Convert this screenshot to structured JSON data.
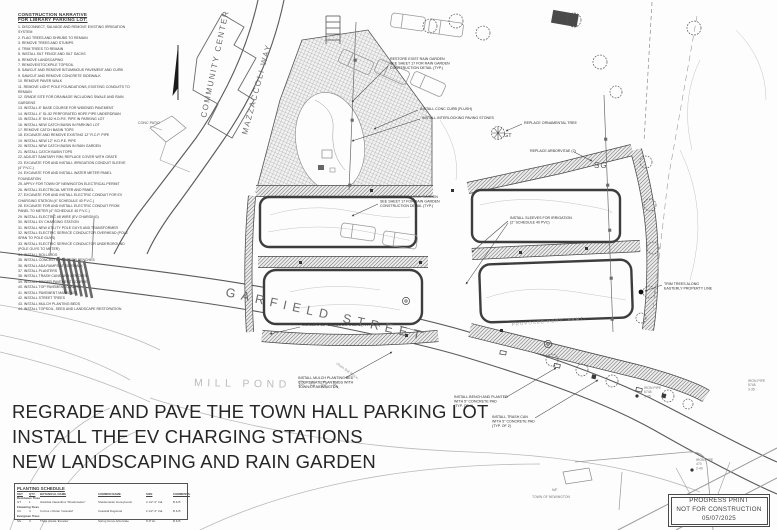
{
  "narrative": {
    "title": "CONSTRUCTION NARRATIVE",
    "subtitle": "FOR LIBRARY PARKING LOT:",
    "items": [
      "DISCONNECT, SALVAGE AND REMOVE EXISTING IRRIGATION SYSTEM",
      "FLAG TREES AND SHRUBS TO REMAIN",
      "REMOVE TREES AND STUMPS",
      "TRIM TREES TO REMAIN",
      "INSTALL SILT FENCE AND SILT SACKS",
      "REMOVE LANDSCAPING",
      "REMOVE/STOCKPILE TOPSOIL",
      "SAWCUT AND REMOVE BITUMINOUS PAVEMENT AND CURB",
      "SAWCUT AND REMOVE CONCRETE SIDEWALK",
      "REMOVE PAVER WALK",
      "REMOVE LIGHT POLE FOUNDATIONS; EXISTING CONDUITS TO REMAIN",
      "GRADE SITE FOR DRAINAGE INCLUDING SWALE AND RAIN GARDENS",
      "INSTALL 8\" BASE COURSE FOR WIDENED PAVEMENT",
      "INSTALL 4\" SL-52 PERFORATED HDPE PIPE UNDERDRAIN",
      "INSTALL 8\" SH-52 H.D.P.E. PIPE IN PARKING LOT",
      "INSTALL NEW CATCH BASIN IN PARKING LOT",
      "REMOVE CATCH BASIN TOPS",
      "EXCAVATE AND REMOVE EXISTING 12\" R.C.P. PIPE",
      "INSTALL NEW 12\" H.D.P.E. PIPE",
      "INSTALL NEW CATCH BASIN IN RAIN GARDEN",
      "INSTALL CATCH BASIN TOPS",
      "ADJUST SANITARY RIM; REPLACE COVER WITH GRATE",
      "EXCAVATE FOR AND INSTALL IRRIGATION CONDUIT SLEEVE (4\" P.V.C.)",
      "EXCAVATE FOR AND INSTALL WATER METER PANEL FOUNDATION",
      "APPLY FOR TOWN OF NEWINGTON ELECTRICAL PERMIT",
      "INSTALL ELECTRICAL METER AND PANEL",
      "EXCAVATE FOR AND INSTALL ELECTRIC CONDUIT FOR EV CHARGING STATION (4\" SCHEDULE 40 P.V.C.)",
      "EXCAVATE FOR AND INSTALL ELECTRIC CONDUIT FROM PANEL TO METER (4\" SCHEDULE 40 P.V.C.)",
      "INSTALL ELECTRIC #8 WIRE (EV CHARGING)",
      "INSTALL EV CHARGING STATION",
      "INSTALL NEW UTILITY POLE GUYS AND TRANSFORMER",
      "INSTALL ELECTRIC SERVICE CONDUCTOR OVERHEAD (POLE SPAN TO POLE GUYS)",
      "INSTALL ELECTRIC SERVICE CONDUCTOR UNDERGROUND (POLE GUYS TO METER)",
      "INSTALL BOLLARDS",
      "INSTALL CONCRETE PADS FOR BENCHES",
      "INSTALL ADA RAMPS AT SIDEWALK",
      "INSTALL PLANTERS",
      "INSTALL TRASH CANS AND BENCHES",
      "INSTALL BINDER PAVEMENT COURSE",
      "INSTALL TOP PAVEMENT COURSE",
      "INSTALL PAVEMENT MARKINGS",
      "INSTALL STREET TREES",
      "INSTALL MULCH PLANTING BEDS",
      "INSTALL TOPSOIL, SEED AND LANDSCAPE RESTORATION"
    ]
  },
  "map": {
    "labels": {
      "garfield": "GARFIELD STREET",
      "mill_pond": "MILL POND PARK",
      "mazzaccoli": "MAZZACCOLI WAY",
      "community_center": "COMMUNITY CENTER",
      "conc_patio": "CONC PATIO",
      "nf": "N/F",
      "town": "TOWN OF NEWINGTON",
      "perv": "PROPOSED PERV. PVMT.",
      "fence": "chain link fence",
      "sg": "SG",
      "gt": "GT"
    },
    "survey1": {
      "l1": "IRON PIPE",
      "l2": "6748",
      "l3": "3-35"
    },
    "survey2": {
      "l1": "IRON PIPE",
      "l2": "470",
      "l3": "2-40"
    },
    "survey3": {
      "l1": "IRON PIPE",
      "l2": "5748",
      "l3": "3-35"
    },
    "callouts": [
      {
        "lines": [
          "RESTORE EXIST RAIN GARDEN",
          "SEE SHEET 17 FOR RAIN GARDEN",
          "CONSTRUCTION DETAIL (TYP.)"
        ]
      },
      {
        "lines": [
          "INSTALL CONC CURB (FLUSH)"
        ]
      },
      {
        "lines": [
          "INSTALL INTERLOCKING PAVING STONES"
        ]
      },
      {
        "lines": [
          "REPLACE ORNAMENTAL TREE"
        ]
      },
      {
        "lines": [
          "REPLACE ARBORVITAE (2)"
        ]
      },
      {
        "lines": [
          "CONSTRUCT NEW RAIN GARDEN",
          "SEE SHEET 17 FOR RAIN GARDEN",
          "CONSTRUCTION DETAIL (TYP.)"
        ]
      },
      {
        "lines": [
          "INSTALL SLEEVES FOR IRRIGATION",
          "(2\" SCHEDULE 40 PVC)"
        ]
      },
      {
        "lines": [
          "INSTALL 2 1/2\"-3\" CALIPER TREES (TYP. OF 4)"
        ]
      },
      {
        "lines": [
          "INSTALL MULCH PLANTING BED",
          "COORDINATE PLANTINGS WITH",
          "TOWN OF NEWINGTON"
        ]
      },
      {
        "lines": [
          "INSTALL BENCH AND PLANTER",
          "WITH 5\" CONCRETE PAD",
          "(TYP. OF 4)"
        ]
      },
      {
        "lines": [
          "INSTALL TRASH CAN",
          "WITH 5\" CONCRETE PAD",
          "(TYP. OF 2)"
        ]
      },
      {
        "lines": [
          "TRIM TREES ALONG",
          "EASTERLY PROPERTY LINE"
        ]
      }
    ]
  },
  "annotation": {
    "line1": "REGRADE AND PAVE THE TOWN HALL PARKING LOT",
    "line2": "INSTALL THE EV CHARGING STATIONS",
    "line3": "NEW LANDSCAPING AND RAIN GARDEN"
  },
  "planting_schedule": {
    "title": "PLANTING SCHEDULE",
    "columns": [
      "KEY",
      "QTY.",
      "BOTANICAL NAME",
      "COMMON NAME",
      "SIZE",
      "COMMENTS"
    ],
    "groups": [
      {
        "label": "Deciduous Trees",
        "rows": [
          {
            "key": "GT",
            "qty": "1",
            "botanical": "Gleditsia triacanthos 'Shademaster'",
            "common": "Shademaster Honeylocust",
            "size": "2 1/2\"-3\" Cal.",
            "comments": "B & B"
          }
        ]
      },
      {
        "label": "Flowering Trees",
        "rows": [
          {
            "key": "CC",
            "qty": "4",
            "botanical": "Cornus x Rutan 'Celestial'",
            "common": "Celestial Dogwood",
            "size": "2 1/2\"-3\" Cal.",
            "comments": "B & B"
          }
        ]
      },
      {
        "label": "Evergreen Trees",
        "rows": [
          {
            "key": "SG",
            "qty": "3",
            "botanical": "Thuja plicata 'Excelsa'",
            "common": "Spring Grove Arborvitae",
            "size": "6'-8' Ht.",
            "comments": "B & B"
          }
        ]
      }
    ]
  },
  "stamp": {
    "line1": "PROGRESS PRINT",
    "line2": "NOT FOR CONSTRUCTION",
    "line3": "05/07/2025"
  }
}
